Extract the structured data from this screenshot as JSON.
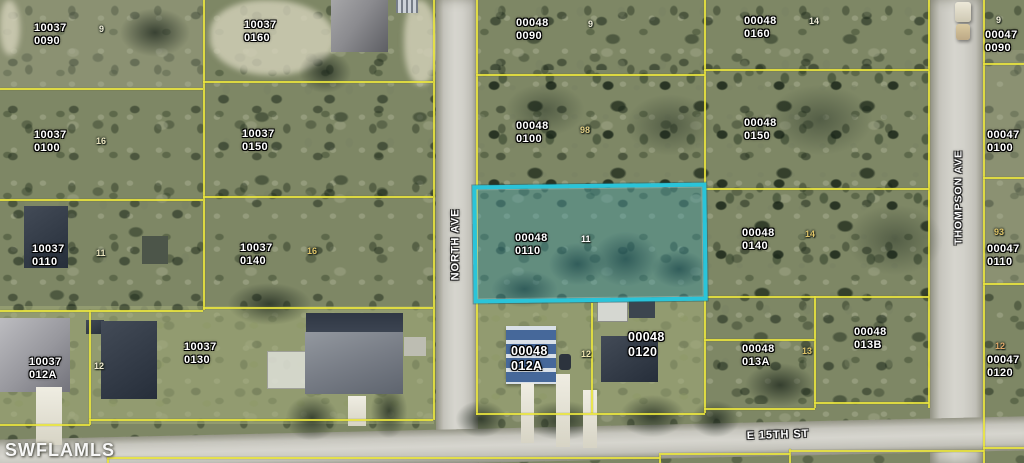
{
  "watermark": "SWFLAMLS",
  "streets": {
    "north_ave": "NORTH AVE",
    "thompson_ave": "THOMPSON AVE",
    "e_15th_st": "E 15TH ST"
  },
  "colors": {
    "highlight_border": "#2ac4d9",
    "highlight_fill": "rgba(45,152,176,0.34)",
    "parcel_line": "#e9e43d"
  },
  "highlighted_parcel_id": "00048 0110",
  "parcels": [
    {
      "block": "10037",
      "lot": "0090",
      "x": 34,
      "y": 22
    },
    {
      "block": "10037",
      "lot": "0160",
      "x": 244,
      "y": 19
    },
    {
      "block": "10037",
      "lot": "0100",
      "x": 34,
      "y": 129
    },
    {
      "block": "10037",
      "lot": "0150",
      "x": 242,
      "y": 128
    },
    {
      "block": "10037",
      "lot": "0110",
      "x": 32,
      "y": 243
    },
    {
      "block": "10037",
      "lot": "0140",
      "x": 240,
      "y": 242
    },
    {
      "block": "10037",
      "lot": "012A",
      "x": 29,
      "y": 356
    },
    {
      "block": "10037",
      "lot": "0130",
      "x": 184,
      "y": 341
    },
    {
      "block": "00048",
      "lot": "0090",
      "x": 516,
      "y": 17
    },
    {
      "block": "00048",
      "lot": "0160",
      "x": 744,
      "y": 15
    },
    {
      "block": "00048",
      "lot": "0100",
      "x": 516,
      "y": 120
    },
    {
      "block": "00048",
      "lot": "0150",
      "x": 744,
      "y": 117
    },
    {
      "block": "00048",
      "lot": "0110",
      "x": 515,
      "y": 232
    },
    {
      "block": "00048",
      "lot": "0140",
      "x": 742,
      "y": 227
    },
    {
      "block": "00048",
      "lot": "012A",
      "x": 511,
      "y": 344,
      "big": true
    },
    {
      "block": "00048",
      "lot": "0120",
      "x": 628,
      "y": 330,
      "big": true
    },
    {
      "block": "00048",
      "lot": "013A",
      "x": 742,
      "y": 343
    },
    {
      "block": "00048",
      "lot": "013B",
      "x": 854,
      "y": 326
    },
    {
      "block": "00047",
      "lot": "0090",
      "x": 985,
      "y": 29
    },
    {
      "block": "00047",
      "lot": "0100",
      "x": 987,
      "y": 129
    },
    {
      "block": "00047",
      "lot": "0110",
      "x": 987,
      "y": 243
    },
    {
      "block": "00047",
      "lot": "0120",
      "x": 987,
      "y": 354
    }
  ],
  "lot_markers": [
    {
      "t": "9",
      "x": 99,
      "y": 24,
      "c": "#f2efda"
    },
    {
      "t": "16",
      "x": 96,
      "y": 136,
      "c": "#e9e3bd"
    },
    {
      "t": "11",
      "x": 96,
      "y": 248,
      "c": "#e9e3bd"
    },
    {
      "t": "12",
      "x": 94,
      "y": 361,
      "c": "#f0ead0"
    },
    {
      "t": "16",
      "x": 307,
      "y": 246,
      "c": "#dfc468"
    },
    {
      "t": "9",
      "x": 588,
      "y": 19,
      "c": "#f2efda"
    },
    {
      "t": "98",
      "x": 580,
      "y": 125,
      "c": "#e2cf86"
    },
    {
      "t": "11",
      "x": 581,
      "y": 234,
      "c": "#ffffff"
    },
    {
      "t": "12",
      "x": 581,
      "y": 349,
      "c": "#eee4ae"
    },
    {
      "t": "14",
      "x": 809,
      "y": 16,
      "c": "#f2efda"
    },
    {
      "t": "14",
      "x": 805,
      "y": 229,
      "c": "#dfc468"
    },
    {
      "t": "13",
      "x": 802,
      "y": 346,
      "c": "#dfc468"
    },
    {
      "t": "9",
      "x": 996,
      "y": 15,
      "c": "#f2efda"
    },
    {
      "t": "93",
      "x": 994,
      "y": 227,
      "c": "#dfc468"
    },
    {
      "t": "12",
      "x": 995,
      "y": 341,
      "c": "#dfa868"
    }
  ]
}
